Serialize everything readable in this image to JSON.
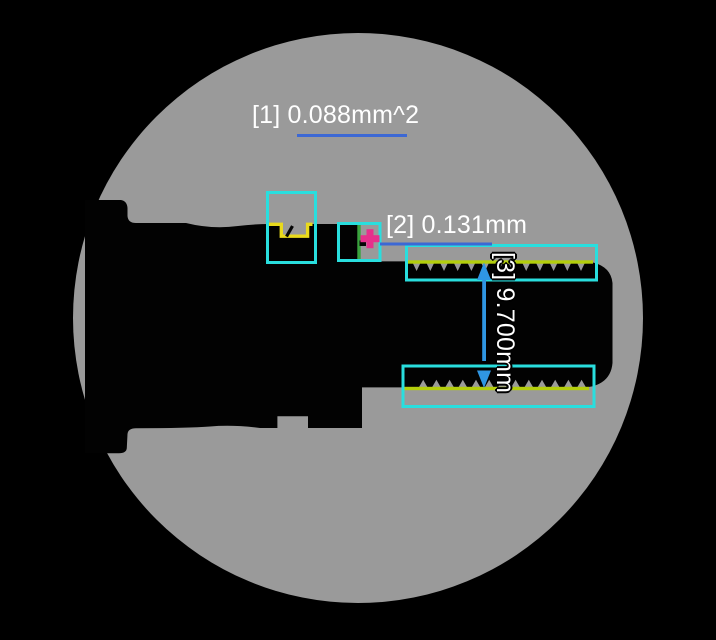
{
  "view": {
    "type": "profile-projector-field-of-view",
    "field_shape": "circle"
  },
  "measurements": [
    {
      "id": "1",
      "label": "[1] 0.088mm^2",
      "kind": "area",
      "value": "0.088",
      "unit": "mm^2"
    },
    {
      "id": "2",
      "label": "[2] 0.131mm",
      "kind": "length",
      "value": "0.131",
      "unit": "mm"
    },
    {
      "id": "3",
      "label": "[3] 9.700mm",
      "kind": "distance",
      "value": "9.700",
      "unit": "mm"
    }
  ],
  "colors": {
    "background_black": "#000000",
    "field_gray": "#9a9a9a",
    "silhouette_black": "#020202",
    "roi_cyan": "#29dede",
    "highlight_yellow": "#e9da1c",
    "crest_chartreuse": "#b3ce0c",
    "edge_green": "#3aa33e",
    "marker_magenta": "#e6308c",
    "measure_blue": "#3c68d4",
    "arrow_blue": "#2f96e3",
    "text_white": "#ffffff"
  }
}
